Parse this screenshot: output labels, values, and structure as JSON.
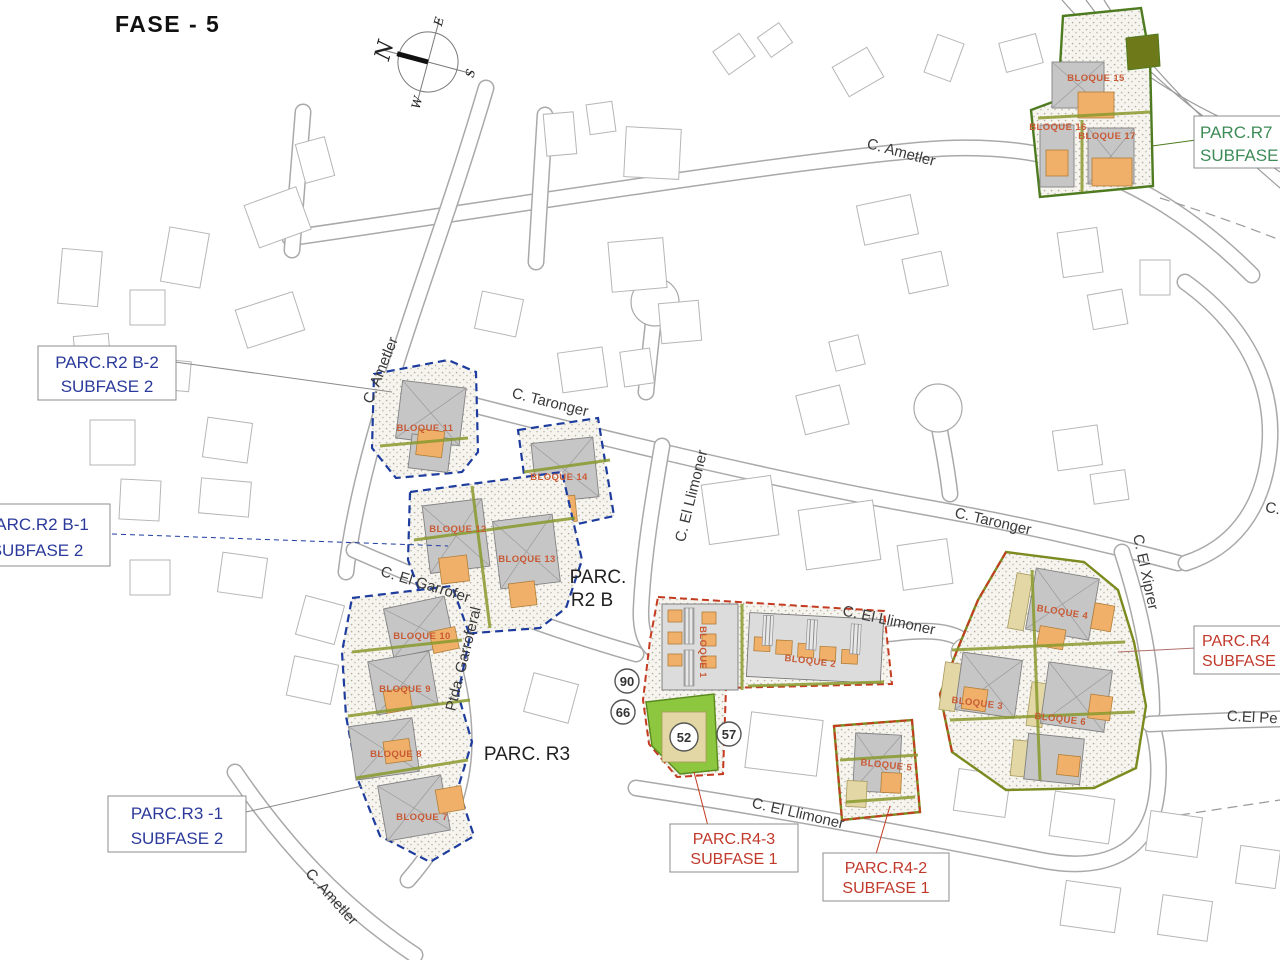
{
  "title": "FASE - 5",
  "compass": {
    "n": "N",
    "e": "E",
    "s": "S",
    "w": "W"
  },
  "streets": [
    "C. Ametler",
    "C. Ametler",
    "C. Taronger",
    "C. Taronger",
    "C. El Llimoner",
    "C. El Llimoner",
    "C. El Llimoner",
    "C. El Garrofer",
    "Ptda. Garroferal",
    "C. El Xiprer",
    "C. Ametler",
    "C.El Pe",
    "C."
  ],
  "areas": {
    "r2b_line1": "PARC.",
    "r2b_line2": "R2 B",
    "r3": "PARC. R3"
  },
  "parcel_boxes": [
    {
      "line1": "PARC.R2 B-2",
      "line2": "SUBFASE 2",
      "color": "#2b3a9b"
    },
    {
      "line1": "PARC.R2 B-1",
      "line2": "SUBFASE 2",
      "color": "#2b3a9b"
    },
    {
      "line1": "PARC.R3 -1",
      "line2": "SUBFASE 2",
      "color": "#2b3a9b"
    },
    {
      "line1": "PARC.R4-3",
      "line2": "SUBFASE 1",
      "color": "#c0392b"
    },
    {
      "line1": "PARC.R4-2",
      "line2": "SUBFASE 1",
      "color": "#c0392b"
    },
    {
      "line1": "PARC.R4",
      "line2": "SUBFASE",
      "color": "#c0392b"
    },
    {
      "line1": "PARC.R7",
      "line2": "SUBFASE",
      "color": "#3d8b57"
    }
  ],
  "bloques": [
    "BLOQUE 1",
    "BLOQUE 2",
    "BLOQUE 3",
    "BLOQUE 4",
    "BLOQUE 5",
    "BLOQUE 6",
    "BLOQUE 7",
    "BLOQUE 8",
    "BLOQUE 9",
    "BLOQUE 10",
    "BLOQUE 11",
    "BLOQUE 12",
    "BLOQUE 13",
    "BLOQUE 14",
    "BLOQUE 15",
    "BLOQUE 16",
    "BLOQUE 17"
  ],
  "markers": [
    "90",
    "66",
    "52",
    "57"
  ],
  "colors": {
    "parcel_outline_blue": "#1d3c9e",
    "parcel_outline_red": "#c43b21",
    "parcel_outline_olive": "#7b8b1f",
    "parcel_outline_green": "#4e7b1f",
    "bloque_text": "#c85a35",
    "building_gray": "#c6c6c6",
    "building_orange": "#f0b06a",
    "building_tan": "#e3d7a6",
    "corner_green": "#8dc63f"
  }
}
